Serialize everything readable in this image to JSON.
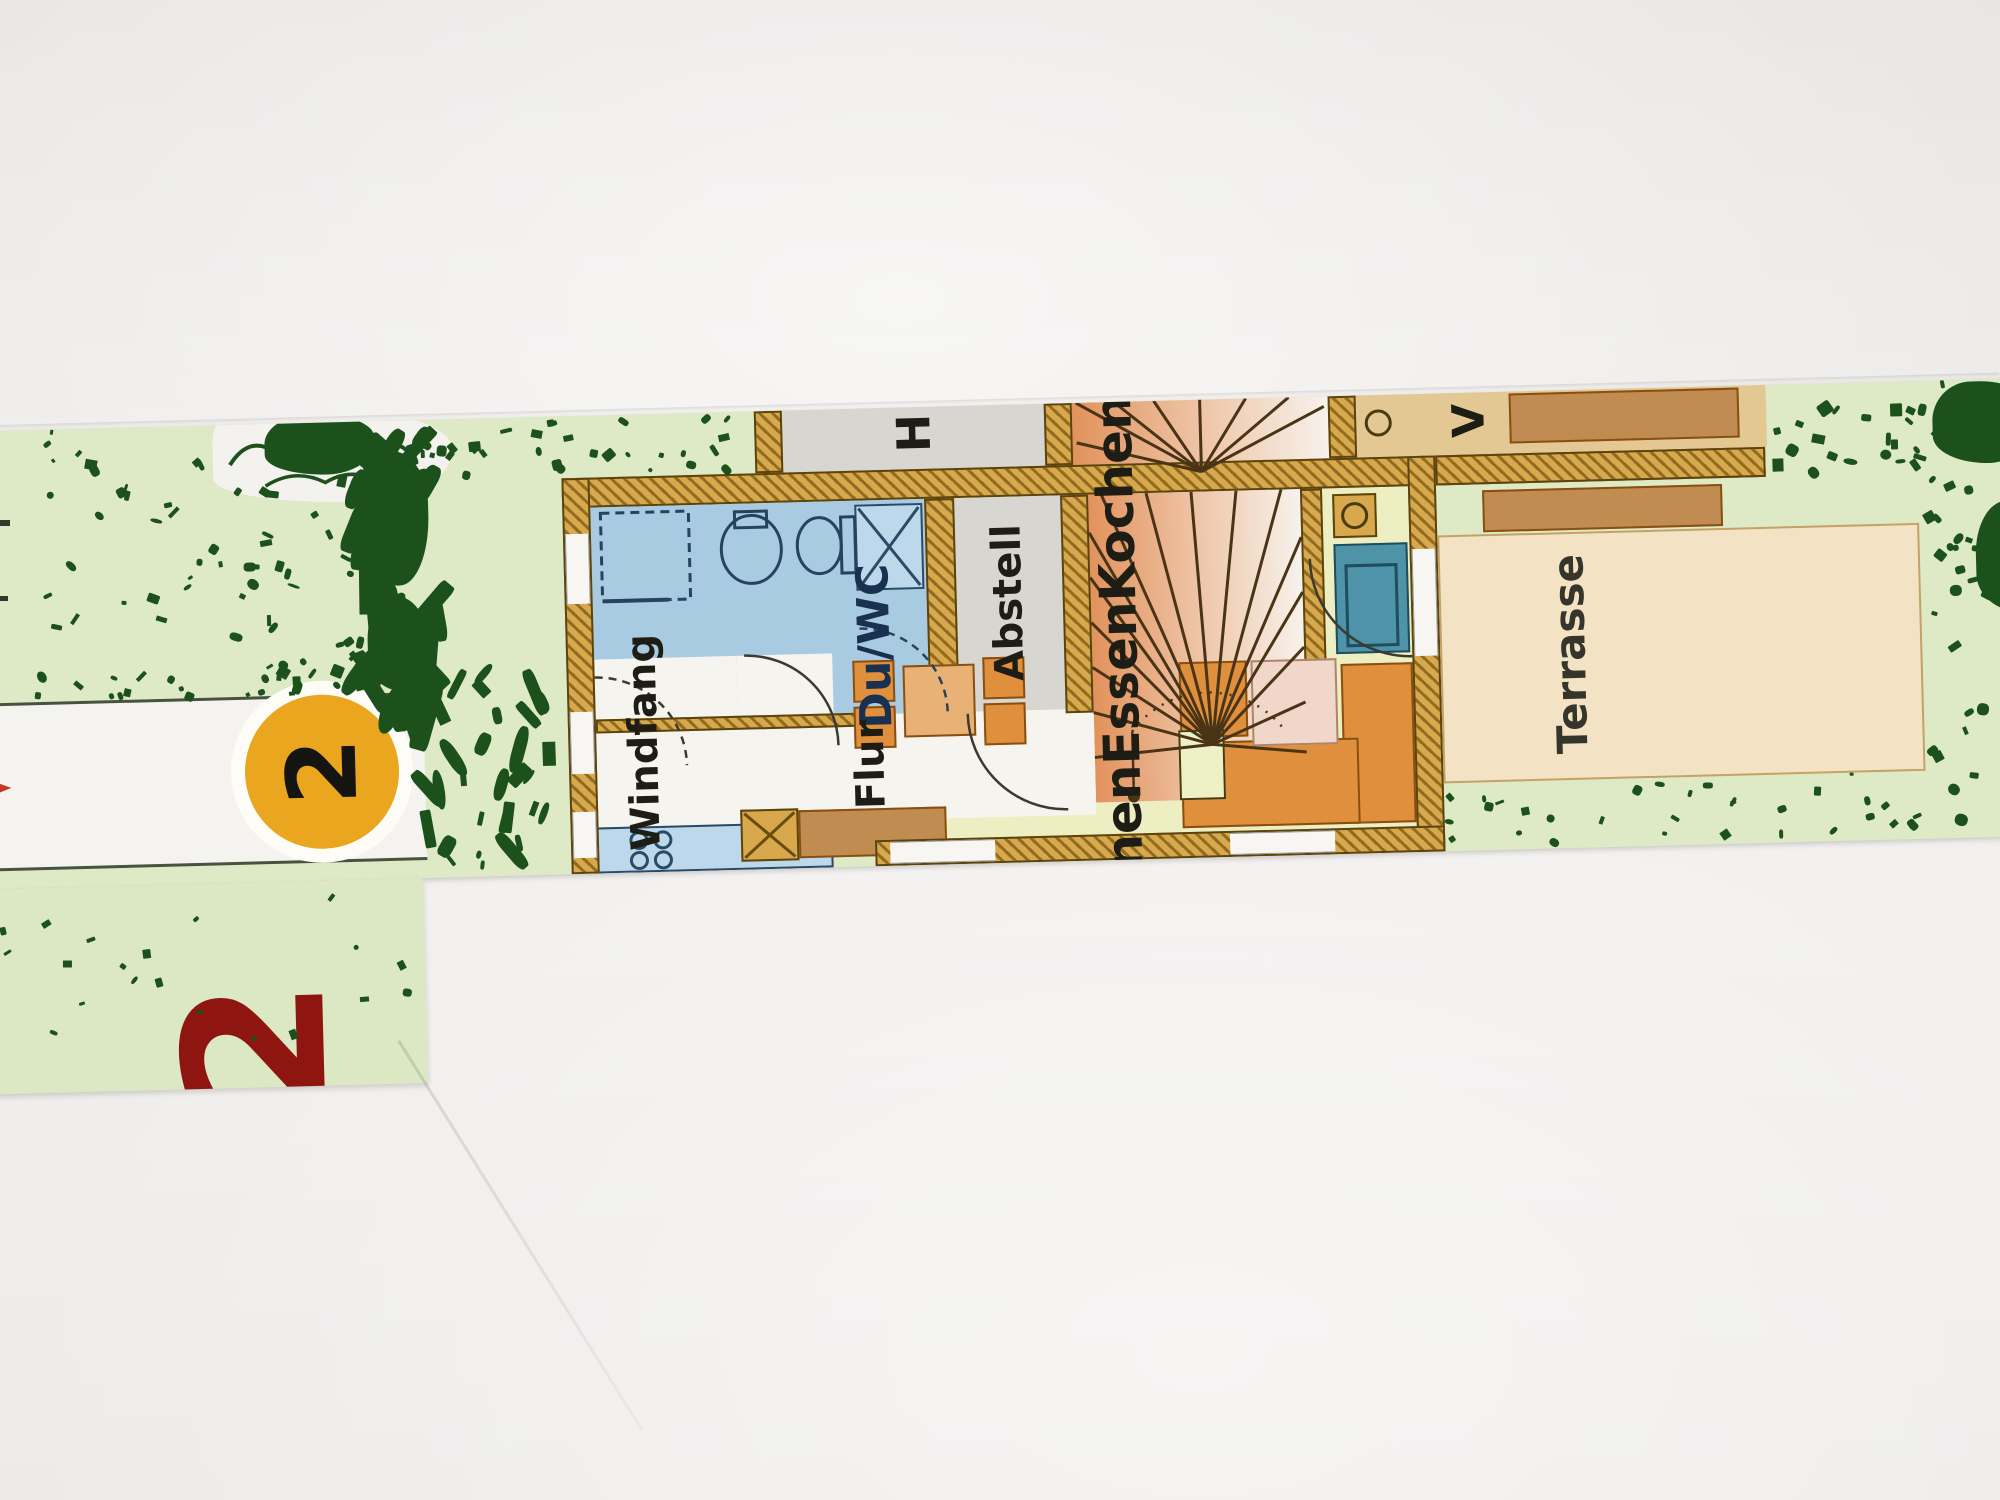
{
  "scene": {
    "type": "photographed floor plan brochure strip on white paper",
    "orientation": "plan rotated 90 degrees, labels read bottom-to-top"
  },
  "street": {
    "unit_badge_number": "2",
    "plot_number": "2"
  },
  "rooms": {
    "h": "H",
    "v": "V",
    "du_wc": "Du/WC",
    "abstell": "Abstell",
    "windfang": {
      "lines": [
        "Wind",
        "fang"
      ]
    },
    "flur": "Flur",
    "living": {
      "lines": [
        "Wohnen",
        "Essen",
        "Kochen"
      ]
    },
    "terrasse": "Terrasse"
  },
  "colors": {
    "paper": "#efedeb",
    "garden_green": "#dee9c6",
    "hedge_dark_green": "#1c511c",
    "road_white": "#f5f3ef",
    "badge_yellow": "#e9a61e",
    "plot_red": "#8e1510",
    "wall_tan": "#d8a84c",
    "bath_blue": "#a9cbe2",
    "living_floor": "#edeec2",
    "stairs_orange": "#e2925c",
    "terrace_beige": "#f3e3c4",
    "furniture_orange": "#e0903c",
    "stove_teal": "#4f93a8",
    "counter_brown": "#c08c52"
  }
}
